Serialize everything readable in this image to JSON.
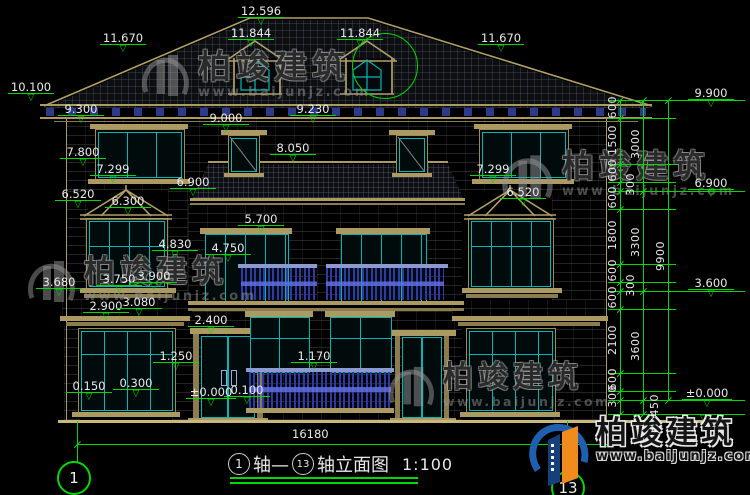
{
  "drawing": {
    "levels": [
      "12.596",
      "11.844",
      "11.844",
      "11.670",
      "11.670",
      "10.100",
      "9.300",
      "9.000",
      "9.230",
      "8.050",
      "7.800",
      "7.299",
      "6.520",
      "6.300",
      "6.900",
      "7.299",
      "6.520",
      "5.700",
      "4.830",
      "4.750",
      "3.680",
      "3.750",
      "3.900",
      "2.900",
      "3.080",
      "2.400",
      "1.250",
      "1.170",
      "0.150",
      "0.300",
      "±0.000",
      "0.100"
    ],
    "levels_right": [
      "9.900",
      "6.900",
      "3.600",
      "±0.000"
    ],
    "dim_segments_small": [
      "600",
      "1500",
      "600",
      "300",
      "600",
      "1800",
      "600",
      "300",
      "600",
      "2100",
      "600",
      "300"
    ],
    "dim_segments_floor": [
      "3000",
      "3300",
      "3600",
      "450"
    ],
    "dim_total_height": "9900",
    "dim_total_width": "16180",
    "axis_start": "1",
    "axis_end": "13",
    "title": {
      "axis_a": "1",
      "mid": "轴—",
      "axis_b": "13",
      "suffix": "轴立面图",
      "scale": "1:100"
    }
  },
  "watermark": {
    "brand": "柏竣建筑",
    "url": "www.baijunjz.com"
  },
  "logo": {
    "brand": "柏竣建筑",
    "url": "www.baijunjz.com"
  },
  "colors": {
    "dim_green": "#00d800",
    "frame_tan": "#ab9a62",
    "glass_cyan": "#00b7b7",
    "railing_blue": "#2b3aa6",
    "brand_blue": "#1e5fb0",
    "brand_orange": "#f08c1e"
  }
}
